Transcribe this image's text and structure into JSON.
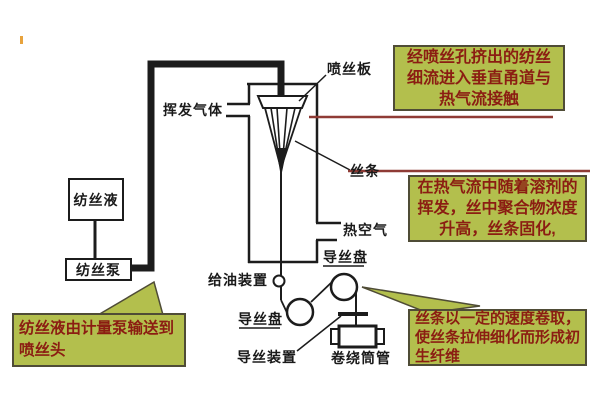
{
  "colors": {
    "callout_fill": "#b3bf4d",
    "callout_border": "#4f4c36",
    "callout_text": "#8b1d12",
    "leader_red": "#8f3b35",
    "line_black": "#1c1c1c",
    "accent_yellow": "#e8a33d"
  },
  "labels": {
    "volatile_gas": "挥发气体",
    "spinneret_plate": "喷丝板",
    "filament": "丝条",
    "hot_air": "热空气",
    "godet_upper": "导丝盘",
    "oiling_device": "给油装置",
    "godet_lower": "导丝盘",
    "guide_device": "导丝装置",
    "winding_bobbin": "卷绕筒管",
    "spinning_solution": "纺丝液",
    "spinning_pump": "纺丝泵"
  },
  "callouts": {
    "top_right": {
      "lines": [
        "经喷丝孔挤出的纺丝",
        "细流进入垂直甬道与",
        "热气流接触"
      ]
    },
    "mid_right": {
      "lines": [
        "在热气流中随着溶剂的",
        "挥发，丝中聚合物浓度",
        "升高，丝条固化,"
      ]
    },
    "bottom_right": {
      "lines": [
        "丝条以一定的速度卷取，",
        "使丝条拉伸细化而形成初",
        "生纤维"
      ]
    },
    "bottom_left": {
      "lines": [
        "纺丝液由计量泵输送到",
        "喷丝头"
      ]
    }
  }
}
